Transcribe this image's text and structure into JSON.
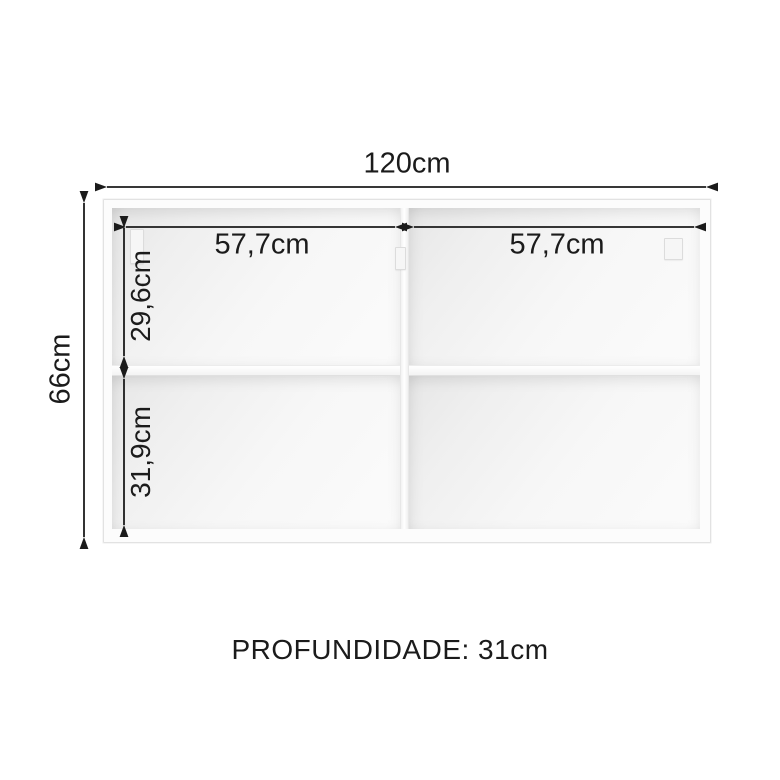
{
  "diagram": {
    "type": "furniture-dimension-diagram",
    "labels": {
      "total_width": "120cm",
      "total_height": "66cm",
      "left_compartment_width": "57,7cm",
      "right_compartment_width": "57,7cm",
      "top_section_height": "29,6cm",
      "bottom_section_height": "31,9cm",
      "depth": "PROFUNDIDADE: 31cm"
    },
    "colors": {
      "background": "#ffffff",
      "dimension_line": "#1b1b1b",
      "label_text": "#1b1b1b",
      "cabinet_frame": "#fcfcfc",
      "cabinet_edge": "#e2e2e2",
      "interior_shadow": "#e7e7e7"
    }
  }
}
